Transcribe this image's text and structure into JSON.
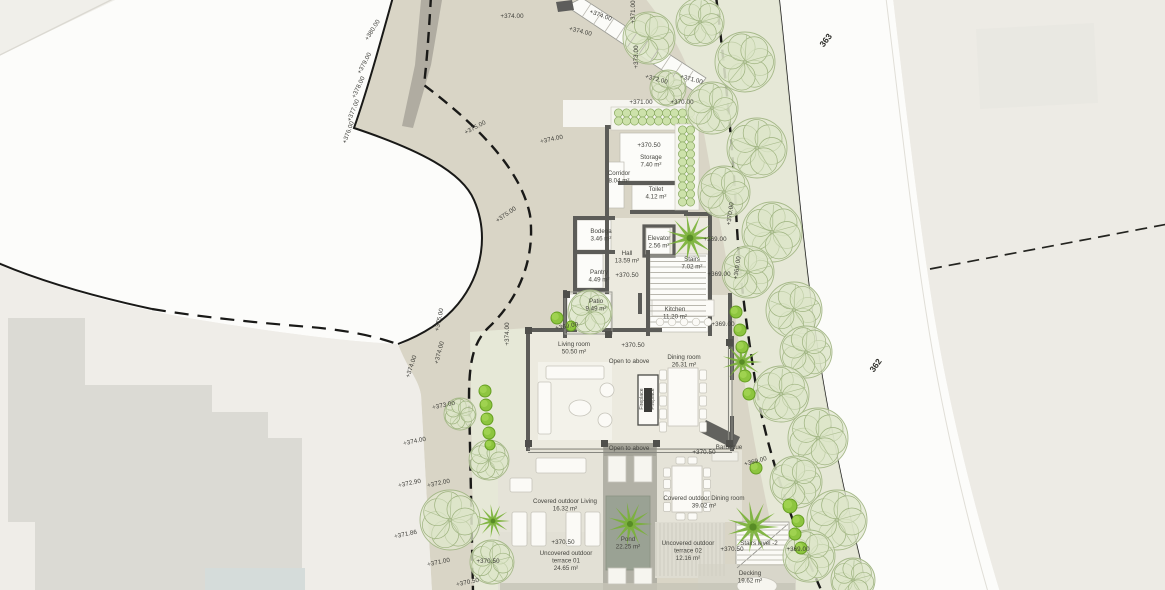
{
  "roads": {
    "upper": {
      "t": "363",
      "x": 828,
      "y": 42,
      "r": -52
    },
    "lower": {
      "t": "362",
      "x": 878,
      "y": 367,
      "r": -55
    }
  },
  "annotations": {
    "elevations": [
      {
        "t": "+380.00",
        "x": 374,
        "y": 31,
        "r": -58
      },
      {
        "t": "+379.00",
        "x": 366,
        "y": 64,
        "r": -62
      },
      {
        "t": "+378.00",
        "x": 360,
        "y": 88,
        "r": -65
      },
      {
        "t": "+377.00",
        "x": 355,
        "y": 111,
        "r": -68
      },
      {
        "t": "+376.00",
        "x": 350,
        "y": 133,
        "r": -70
      },
      {
        "t": "+374.00",
        "x": 512,
        "y": 18,
        "r": 0
      },
      {
        "t": "+374.00",
        "x": 600,
        "y": 17,
        "r": 20
      },
      {
        "t": "+374.00",
        "x": 580,
        "y": 33,
        "r": 14
      },
      {
        "t": "+371.00",
        "x": 635,
        "y": 12,
        "r": -90
      },
      {
        "t": "+373.00",
        "x": 638,
        "y": 57,
        "r": -90
      },
      {
        "t": "+372.00",
        "x": 656,
        "y": 81,
        "r": 15
      },
      {
        "t": "+371.00",
        "x": 691,
        "y": 81,
        "r": 15
      },
      {
        "t": "+371.00",
        "x": 641,
        "y": 104,
        "r": 0
      },
      {
        "t": "+370.00",
        "x": 682,
        "y": 104,
        "r": 0
      },
      {
        "t": "+375.00",
        "x": 476,
        "y": 129,
        "r": -28
      },
      {
        "t": "+374.00",
        "x": 552,
        "y": 141,
        "r": -12
      },
      {
        "t": "+375.00",
        "x": 507,
        "y": 216,
        "r": -35
      },
      {
        "t": "+375.00",
        "x": 441,
        "y": 320,
        "r": -78
      },
      {
        "t": "+374.00",
        "x": 441,
        "y": 353,
        "r": -75
      },
      {
        "t": "+374.00",
        "x": 413,
        "y": 367,
        "r": -72
      },
      {
        "t": "+374.00",
        "x": 509,
        "y": 334,
        "r": -90
      },
      {
        "t": "+373.00",
        "x": 444,
        "y": 407,
        "r": -12
      },
      {
        "t": "+374.00",
        "x": 415,
        "y": 443,
        "r": -12
      },
      {
        "t": "+372.90",
        "x": 410,
        "y": 485,
        "r": -12
      },
      {
        "t": "+372.00",
        "x": 439,
        "y": 485,
        "r": -12
      },
      {
        "t": "+371.86",
        "x": 406,
        "y": 536,
        "r": -12
      },
      {
        "t": "+371.00",
        "x": 439,
        "y": 564,
        "r": -12
      },
      {
        "t": "+370.50",
        "x": 488,
        "y": 563,
        "r": 0
      },
      {
        "t": "+370.50",
        "x": 468,
        "y": 584,
        "r": -12
      },
      {
        "t": "+370.00",
        "x": 732,
        "y": 214,
        "r": -82
      },
      {
        "t": "+369.00",
        "x": 715,
        "y": 241,
        "r": 0
      },
      {
        "t": "+369.00",
        "x": 739,
        "y": 268,
        "r": -82
      },
      {
        "t": "+369.00",
        "x": 719,
        "y": 276,
        "r": 0
      },
      {
        "t": "+369.00",
        "x": 723,
        "y": 326,
        "r": 0
      },
      {
        "t": "+369.00",
        "x": 756,
        "y": 463,
        "r": -15
      },
      {
        "t": "+369.00",
        "x": 798,
        "y": 551,
        "r": 0
      },
      {
        "t": "+370.50",
        "x": 649,
        "y": 147,
        "r": 0
      },
      {
        "t": "+370.50",
        "x": 627,
        "y": 277,
        "r": 0
      },
      {
        "t": "+369.00",
        "x": 567,
        "y": 328,
        "r": -10
      },
      {
        "t": "+370.50",
        "x": 633,
        "y": 347,
        "r": 0
      },
      {
        "t": "+370.50",
        "x": 704,
        "y": 454,
        "r": 0
      },
      {
        "t": "+370.50",
        "x": 563,
        "y": 544,
        "r": 0
      },
      {
        "t": "+370.50",
        "x": 732,
        "y": 551,
        "r": 0
      }
    ],
    "rooms": [
      {
        "lines": [
          "Storage",
          "7.40 m²"
        ],
        "x": 651,
        "y": 159
      },
      {
        "lines": [
          "Corridor",
          "8.04 m²"
        ],
        "x": 619,
        "y": 175
      },
      {
        "lines": [
          "Toilet",
          "4.12 m²"
        ],
        "x": 656,
        "y": 191
      },
      {
        "lines": [
          "Bodega",
          "3.46 m²"
        ],
        "x": 601,
        "y": 233
      },
      {
        "lines": [
          "Elevator",
          "2.56 m²"
        ],
        "x": 659,
        "y": 240
      },
      {
        "lines": [
          "Hall",
          "13.59 m²"
        ],
        "x": 627,
        "y": 255
      },
      {
        "lines": [
          "Stairs",
          "7.02 m²"
        ],
        "x": 692,
        "y": 261
      },
      {
        "lines": [
          "Pantry",
          "4.49 m²"
        ],
        "x": 599,
        "y": 274
      },
      {
        "lines": [
          "Patio",
          "9.49 m²"
        ],
        "x": 596,
        "y": 303
      },
      {
        "lines": [
          "Living room",
          "50.50 m²"
        ],
        "x": 574,
        "y": 346
      },
      {
        "lines": [
          "Open to above"
        ],
        "x": 629,
        "y": 363
      },
      {
        "lines": [
          "Dining room",
          "26.31 m²"
        ],
        "x": 684,
        "y": 359
      },
      {
        "lines": [
          "Kitchen",
          "11.20 m²"
        ],
        "x": 675,
        "y": 311
      },
      {
        "lines": [
          "Open to above"
        ],
        "x": 629,
        "y": 450
      },
      {
        "lines": [
          "Covered outdoor Living",
          "16.32 m²"
        ],
        "x": 565,
        "y": 503
      },
      {
        "lines": [
          "Covered outdoor Dining room",
          "39.02 m²"
        ],
        "x": 704,
        "y": 500
      },
      {
        "lines": [
          "Pond",
          "22.25 m²"
        ],
        "x": 628,
        "y": 541
      },
      {
        "lines": [
          "Uncovered outdoor",
          "terrace 01",
          "24.65 m²"
        ],
        "x": 566,
        "y": 555
      },
      {
        "lines": [
          "Uncovered outdoor",
          "terrace 02",
          "12.16 m²"
        ],
        "x": 688,
        "y": 545
      },
      {
        "lines": [
          "Stairs level -2"
        ],
        "x": 759,
        "y": 545
      },
      {
        "lines": [
          "Decking",
          "19.62 m²"
        ],
        "x": 750,
        "y": 575
      },
      {
        "lines": [
          "Barbecue"
        ],
        "x": 729,
        "y": 449
      }
    ],
    "vertical": [
      {
        "t": "Fireplace",
        "x": 643,
        "y": 399
      },
      {
        "t": "Fireplace",
        "x": 654,
        "y": 399
      }
    ]
  },
  "vegetation": {
    "trees": [
      [
        649,
        38,
        26
      ],
      [
        700,
        22,
        24
      ],
      [
        745,
        62,
        30
      ],
      [
        712,
        108,
        26
      ],
      [
        757,
        148,
        30
      ],
      [
        724,
        192,
        26
      ],
      [
        772,
        232,
        30
      ],
      [
        748,
        272,
        26
      ],
      [
        794,
        310,
        28
      ],
      [
        806,
        352,
        26
      ],
      [
        781,
        394,
        28
      ],
      [
        818,
        438,
        30
      ],
      [
        796,
        482,
        26
      ],
      [
        837,
        520,
        30
      ],
      [
        809,
        556,
        26
      ],
      [
        853,
        580,
        22
      ],
      [
        590,
        312,
        22
      ],
      [
        450,
        520,
        30
      ],
      [
        489,
        460,
        20
      ],
      [
        492,
        562,
        22
      ],
      [
        460,
        414,
        16
      ],
      [
        668,
        88,
        18
      ]
    ],
    "palms": [
      [
        690,
        238,
        24
      ],
      [
        742,
        362,
        20
      ],
      [
        630,
        524,
        22
      ],
      [
        753,
        527,
        26
      ],
      [
        493,
        521,
        17
      ]
    ],
    "bushes": [
      [
        485,
        391,
        6
      ],
      [
        486,
        405,
        6
      ],
      [
        487,
        419,
        6
      ],
      [
        489,
        433,
        6
      ],
      [
        490,
        445,
        5
      ],
      [
        557,
        318,
        6
      ],
      [
        571,
        326,
        5
      ],
      [
        736,
        312,
        6
      ],
      [
        740,
        330,
        6
      ],
      [
        742,
        347,
        6
      ],
      [
        745,
        376,
        6
      ],
      [
        749,
        394,
        6
      ],
      [
        756,
        468,
        6
      ],
      [
        790,
        506,
        7
      ],
      [
        798,
        521,
        6
      ],
      [
        795,
        534,
        6
      ],
      [
        801,
        548,
        6
      ]
    ],
    "hedges": [
      {
        "x": 613,
        "y": 109,
        "w": 84,
        "h": 19
      },
      {
        "x": 677,
        "y": 126,
        "w": 20,
        "h": 82
      }
    ]
  },
  "colors": {
    "background": "#efede8",
    "parcel": "#d9d5c6",
    "road_white": "#fcfcfa",
    "green_band": "#e7ead8",
    "wall": "#5c5c58",
    "pond": "#9aa294",
    "neighbor_building": "#dbdad4",
    "bush_green": "#8dc53f",
    "text": "#3d3d38"
  }
}
